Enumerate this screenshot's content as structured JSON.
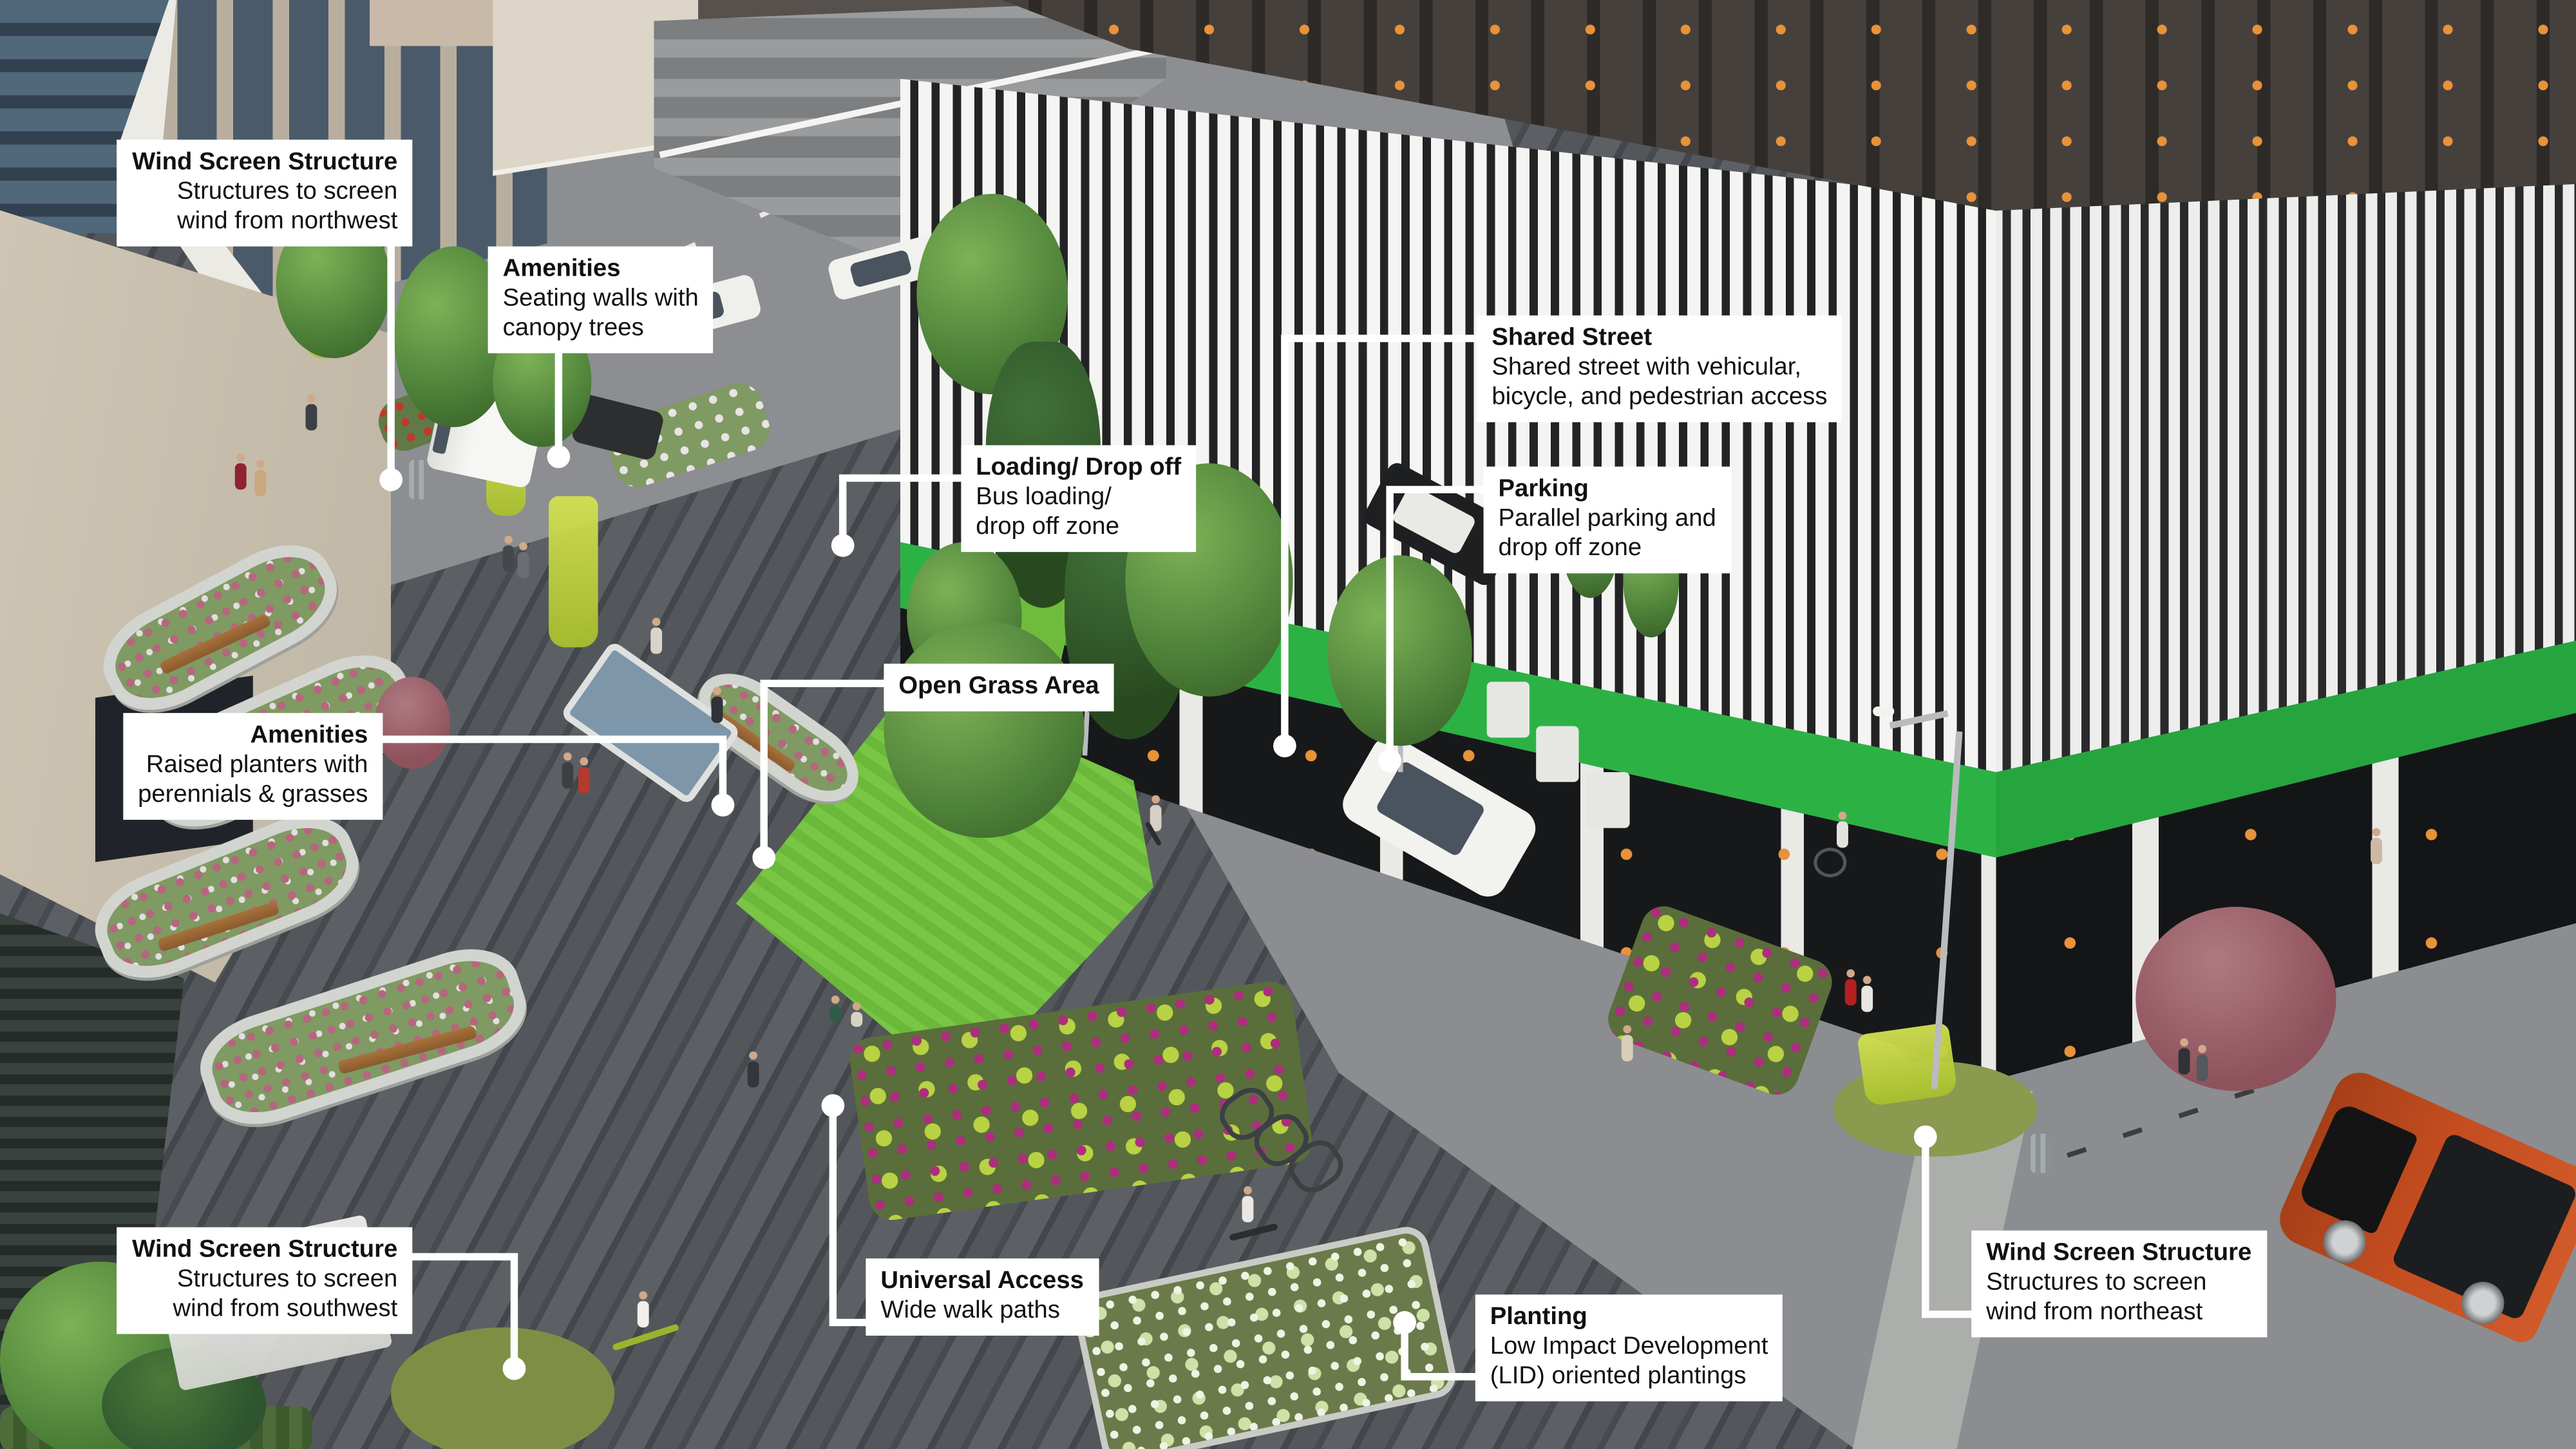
{
  "image_title": "Annotated streetscape design concept rendering",
  "colors": {
    "callout_bg": "#ffffff",
    "callout_text": "#111111",
    "leader_line": "#ffffff",
    "building_band_green": "#2cb244",
    "wind_screen_lime": "#bed03d",
    "grass_green": "#79c544",
    "street_asphalt": "#8b8d90",
    "plaza_paving": "#4a4e51",
    "suv_orange": "#c44d20"
  },
  "callouts": [
    {
      "id": "wind-screen-nw",
      "title": "Wind Screen Structure",
      "line1": "Structures to screen",
      "line2": "wind from northwest"
    },
    {
      "id": "amenities-seating",
      "title": "Amenities",
      "line1": "Seating walls with",
      "line2": "canopy trees"
    },
    {
      "id": "shared-street",
      "title": "Shared Street",
      "line1": "Shared street with vehicular,",
      "line2": "bicycle, and pedestrian access"
    },
    {
      "id": "loading-drop-off",
      "title": "Loading/ Drop off",
      "line1": "Bus loading/",
      "line2": "drop off zone"
    },
    {
      "id": "parking",
      "title": "Parking",
      "line1": "Parallel parking and",
      "line2": "drop off zone"
    },
    {
      "id": "open-grass-area",
      "title": "Open Grass Area"
    },
    {
      "id": "amenities-planters",
      "title": "Amenities",
      "line1": "Raised planters with",
      "line2": "perennials & grasses"
    },
    {
      "id": "wind-screen-sw",
      "title": "Wind Screen Structure",
      "line1": "Structures to screen",
      "line2": "wind from southwest"
    },
    {
      "id": "universal-access",
      "title": "Universal Access",
      "line1": "Wide walk paths"
    },
    {
      "id": "planting",
      "title": "Planting",
      "line1": "Low Impact Development",
      "line2": "(LID) oriented plantings"
    },
    {
      "id": "wind-screen-ne",
      "title": "Wind Screen Structure",
      "line1": "Structures to screen",
      "line2": "wind from northeast"
    }
  ]
}
